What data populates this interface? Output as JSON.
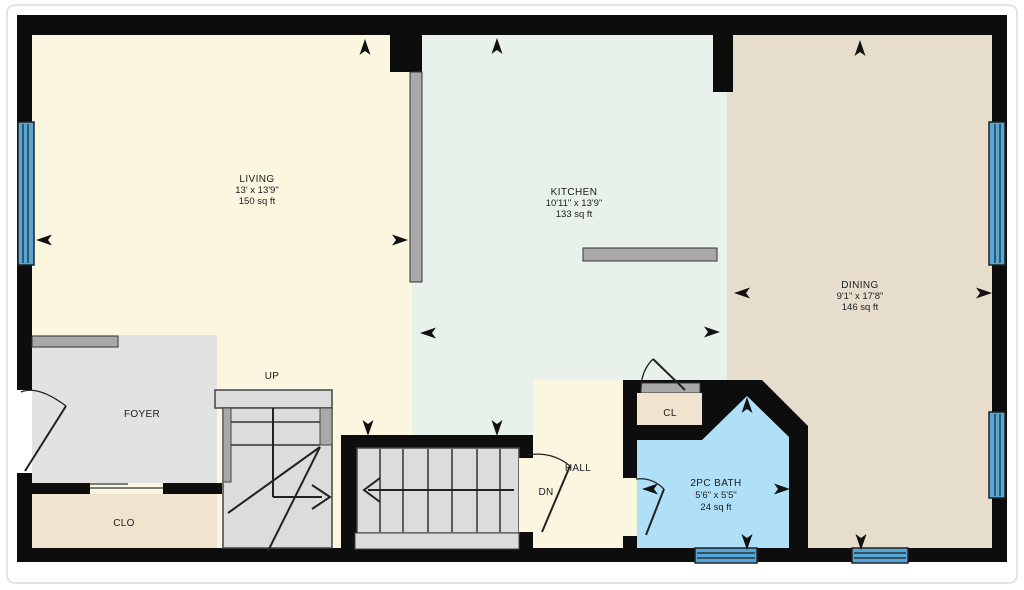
{
  "plan": {
    "rooms": {
      "living": {
        "name": "LIVING",
        "dimensions": "13' x 13'9\"",
        "area": "150 sq ft"
      },
      "kitchen": {
        "name": "KITCHEN",
        "dimensions": "10'11\" x 13'9\"",
        "area": "133 sq ft"
      },
      "dining": {
        "name": "DINING",
        "dimensions": "9'1\" x 17'8\"",
        "area": "146 sq ft"
      },
      "bath": {
        "name": "2PC BATH",
        "dimensions": "5'6\" x 5'5\"",
        "area": "24 sq ft"
      },
      "foyer": {
        "name": "FOYER"
      },
      "hall": {
        "name": "HALL"
      },
      "closet": {
        "name": "CLO"
      },
      "closet_small": {
        "name": "CL"
      }
    },
    "stairs": {
      "up_label": "UP",
      "down_label": "DN"
    },
    "colors": {
      "wall": "#0d0d0d",
      "living": "#FBF6E0",
      "kitchen": "#E9F2EA",
      "dining": "#E7DDCC",
      "hall": "#FBF6E0",
      "foyer": "#E2E2E2",
      "closet": "#F0E4CF",
      "bath": "#AFE0F8",
      "window": "#54A7D7",
      "stairs": "#DCDCDC",
      "partial_wall": "#A9A9A9"
    }
  }
}
